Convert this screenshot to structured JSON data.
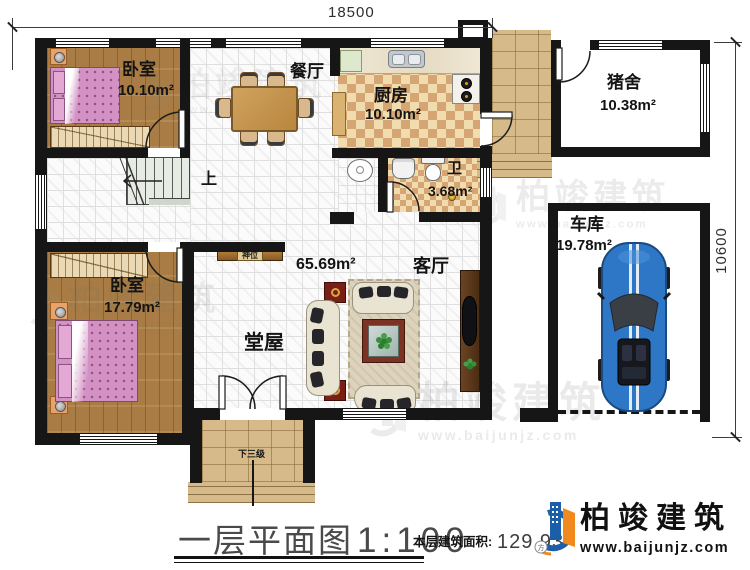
{
  "dimensions": {
    "width_label": "18500",
    "height_label": "10600"
  },
  "rooms": {
    "bedroom_top": {
      "name": "卧室",
      "area": "10.10m²"
    },
    "dining": {
      "name": "餐厅"
    },
    "kitchen": {
      "name": "厨房",
      "area": "10.10m²"
    },
    "pigsty": {
      "name": "猪舍",
      "area": "10.38m²"
    },
    "bath": {
      "name": "卫",
      "area": "3.68m²"
    },
    "garage": {
      "name": "车库",
      "area": "19.78m²"
    },
    "bedroom_bottom": {
      "name": "卧室",
      "area": "17.79m²"
    },
    "hall": {
      "name": "堂屋",
      "area": "65.69m²"
    },
    "living": {
      "name": "客厅"
    },
    "shrine_label": "神位",
    "stair_up_label": "上",
    "entry_steps_label": "下三级"
  },
  "footer": {
    "title": "一层平面图",
    "scale": "1:100",
    "area_label": "本层建筑面积:",
    "area_value": "129.93"
  },
  "brand": {
    "name": "柏竣建筑",
    "website": "www.baijunjz.com"
  },
  "watermark": {
    "text": "柏竣建筑",
    "website": "www.baijunjz.com"
  },
  "colors": {
    "wall": "#161616",
    "wood_floor": "#a87c44",
    "checker_light": "#f0dcae",
    "checker_dark": "#d5a673",
    "paving": "#d7ba8a",
    "bed_pink": "#d492c4",
    "car_blue": "#2e77c6",
    "brand_blue": "#1b5fa8",
    "brand_orange": "#f08a1e"
  }
}
